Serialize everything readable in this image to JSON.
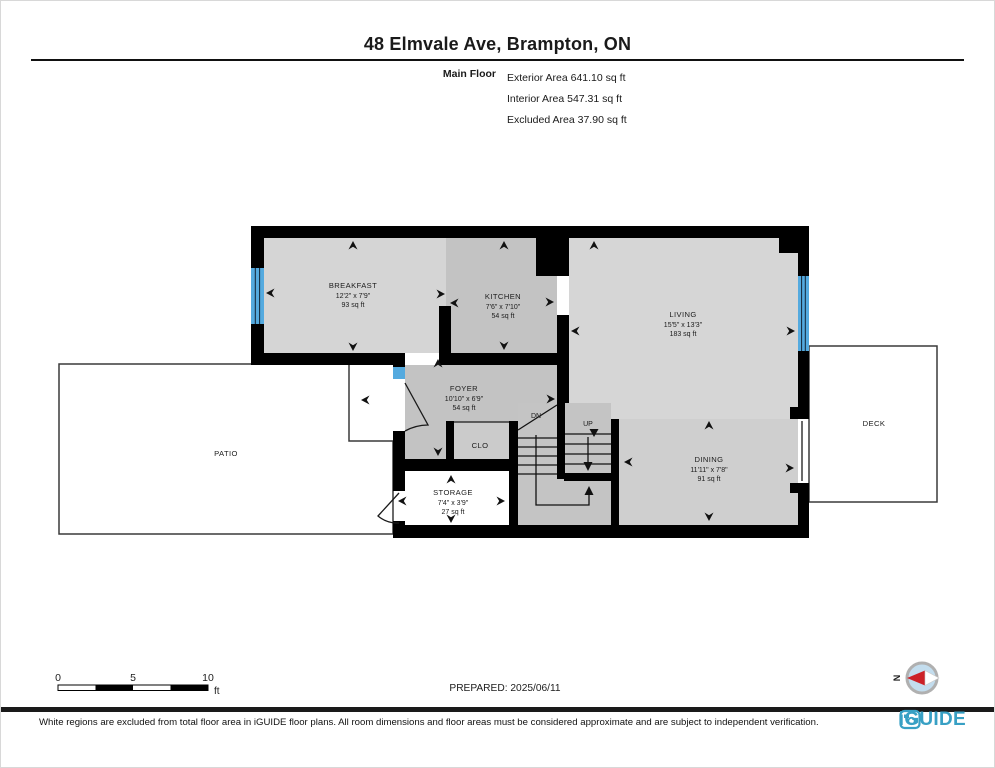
{
  "header": {
    "title": "48 Elmvale Ave, Brampton, ON",
    "floor_label": "Main Floor",
    "stats": [
      "Exterior Area 641.10 sq ft",
      "Interior Area 547.31 sq ft",
      "Excluded Area 37.90 sq ft"
    ]
  },
  "rooms": {
    "breakfast": {
      "name": "BREAKFAST",
      "dims": "12'2\" x 7'9\"",
      "area": "93 sq ft"
    },
    "kitchen": {
      "name": "KITCHEN",
      "dims": "7'6\" x 7'10\"",
      "area": "54 sq ft"
    },
    "living": {
      "name": "LIVING",
      "dims": "15'5\" x 13'3\"",
      "area": "183 sq ft"
    },
    "foyer": {
      "name": "FOYER",
      "dims": "10'10\" x 6'9\"",
      "area": "54 sq ft"
    },
    "dining": {
      "name": "DINING",
      "dims": "11'11\" x 7'8\"",
      "area": "91 sq ft"
    },
    "storage": {
      "name": "STORAGE",
      "dims": "7'4\" x 3'9\"",
      "area": "27 sq ft"
    },
    "closet": {
      "name": "CLO"
    },
    "patio": {
      "name": "PATIO"
    },
    "deck": {
      "name": "DECK"
    }
  },
  "stairs": {
    "up_label": "UP",
    "down_label": "DN"
  },
  "scale_bar": {
    "ticks": [
      "0",
      "5",
      "10"
    ],
    "unit": "ft"
  },
  "compass": {
    "north_label": "N"
  },
  "prepared": "PREPARED: 2025/06/11",
  "footer": {
    "disclaimer": "White regions are excluded from total floor area in iGUIDE floor plans. All room dimensions and floor areas must be considered approximate and are subject to independent verification.",
    "brand": "iGUIDE"
  },
  "colors": {
    "wall": "#000000",
    "room_light": "#d5d5d5",
    "room_medium": "#c3c3c3",
    "dining_gray": "#cfcfcf",
    "window_blue": "#54aadf",
    "excluded_white": "#ffffff",
    "brand_teal": "#38a0c4",
    "compass_red": "#cc2127"
  }
}
